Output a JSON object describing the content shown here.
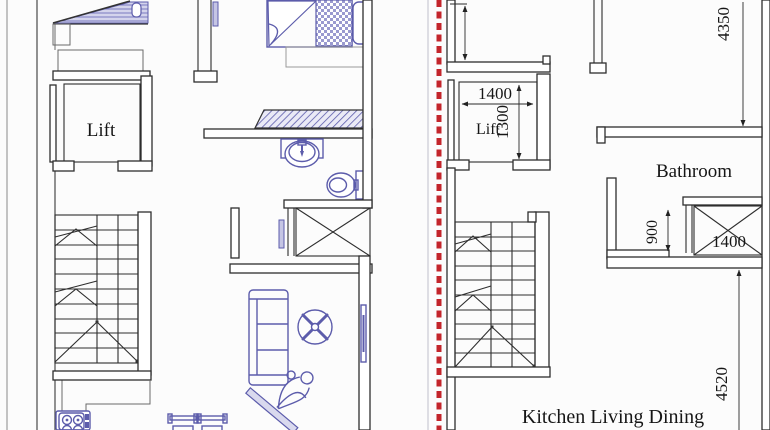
{
  "drawing": {
    "kind": "architectural floor plan, two units divided by red dashed line"
  },
  "labels": {
    "lift_left": "Lift",
    "lift_right": "Lift",
    "bathroom": "Bathroom",
    "kitchen_living_dining": "Kitchen Living Dining"
  },
  "dimensions": {
    "lift_width": "1400",
    "lift_depth": "1300",
    "upper_right_span": "4350",
    "duct_offset": "900",
    "duct_width": "1400",
    "lower_right_span": "4520"
  },
  "colors": {
    "wall_line": "#2e2e2e",
    "furniture_line": "#5c5cab",
    "hatch_fill": "#d4d4ec",
    "divider_red": "#c3252b",
    "background": "#fcfcfc"
  }
}
